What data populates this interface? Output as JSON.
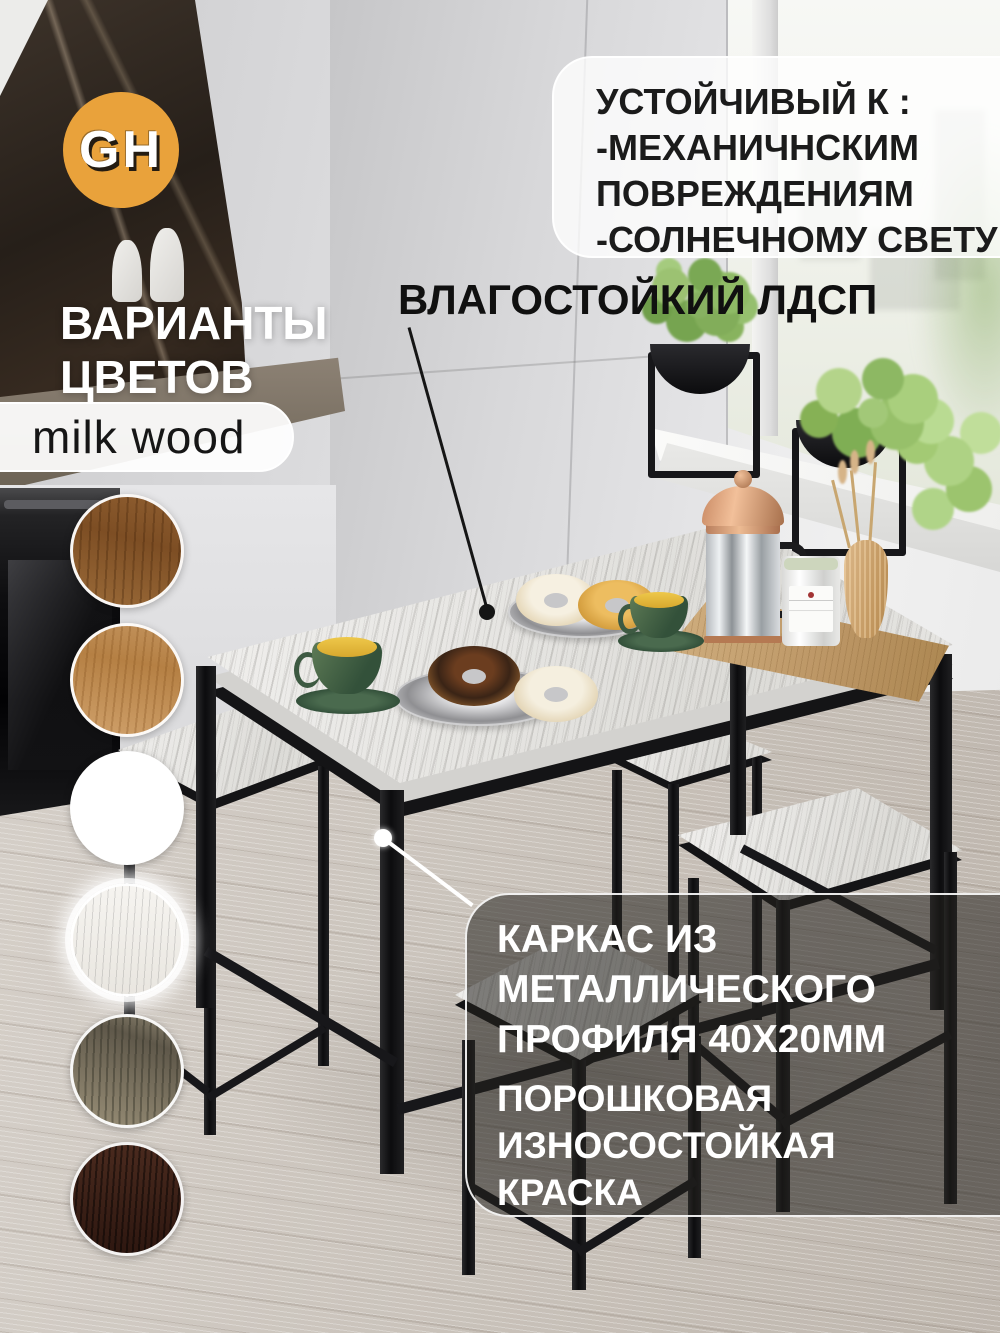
{
  "brand_logo": {
    "text": "GH",
    "circle_color": "#E9A23B",
    "text_color": "#FFFFFF"
  },
  "durability_box": {
    "line1": "УСТОЙЧИВЫЙ К :",
    "line2": "-МЕХАНИЧНСКИМ",
    "line3": "ПОВРЕЖДЕНИЯМ",
    "line4": "-СОЛНЕЧНОМУ СВЕТУ"
  },
  "tabletop_label": {
    "text": "ВЛАГОСТОЙКИЙ ЛДСП"
  },
  "color_variants": {
    "title_line1": "ВАРИАНТЫ",
    "title_line2": "ЦВЕТОВ",
    "selected_name": "milk wood",
    "swatches": [
      {
        "name": "oak-wotan-dark",
        "color": "#8A5A2E"
      },
      {
        "name": "oak-wotan-light",
        "color": "#C2925C"
      },
      {
        "name": "white",
        "color": "#FFFFFF"
      },
      {
        "name": "milk-wood",
        "color": "#F1EFEA"
      },
      {
        "name": "weathered-gray",
        "color": "#8C8470"
      },
      {
        "name": "wenge",
        "color": "#3B2117"
      }
    ]
  },
  "frame_box": {
    "para1_line1": "КАРКАС ИЗ",
    "para1_line2": "МЕТАЛЛИЧЕСКОГО",
    "para1_line3": "ПРОФИЛЯ 40Х20ММ",
    "para2_line1": "ПОРОШКОВАЯ",
    "para2_line2": "ИЗНОСОСТОЙКАЯ",
    "para2_line3": "КРАСКА"
  },
  "overlay_colors": {
    "light_box_bg": "rgba(255,255,255,0.78)",
    "dark_box_bg": "rgba(35,32,30,0.55)"
  }
}
